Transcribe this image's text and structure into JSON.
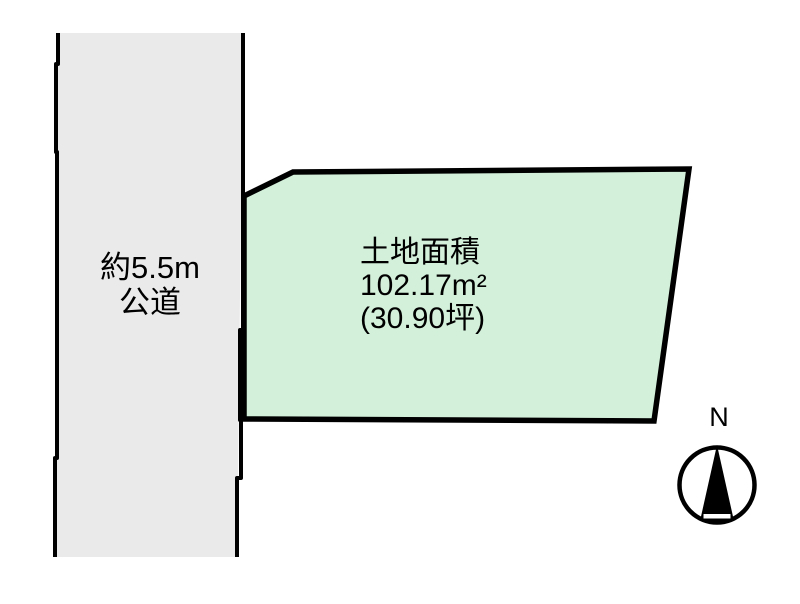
{
  "road": {
    "width_label": "約5.5m",
    "type_label": "公道"
  },
  "parcel": {
    "area_title": "土地面積",
    "area_sqm": "102.17m²",
    "area_tsubo": "(30.90坪)"
  },
  "compass": {
    "north_label": "N"
  },
  "colors": {
    "road_fill": "#eaeaea",
    "parcel_fill": "#d3f0da",
    "line": "#000000",
    "compass_needle": "#000000",
    "background": "#ffffff"
  }
}
